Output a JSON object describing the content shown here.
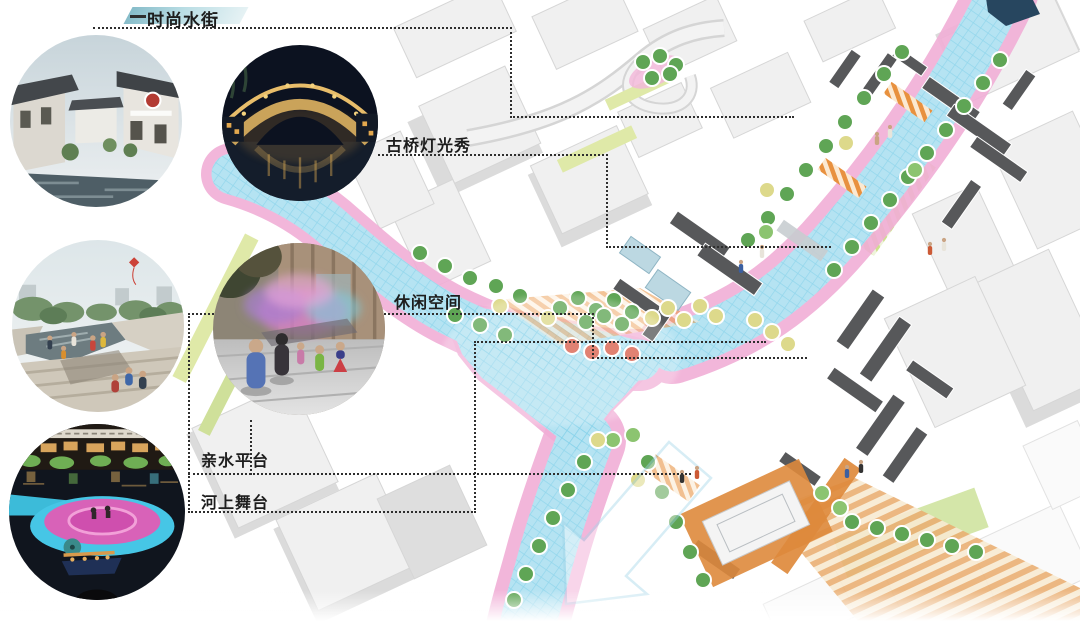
{
  "title": "waterfront-masterplan-diagram",
  "callouts": [
    {
      "id": "fashion-water-street",
      "label": "时尚水街",
      "photo": "traditional-water-street-rendering"
    },
    {
      "id": "bridge-light-show",
      "label": "古桥灯光秀",
      "photo": "stone-arch-bridge-night-photo"
    },
    {
      "id": "leisure-space",
      "label": "休闲空间",
      "photo": "mist-fountain-plaza-photo"
    },
    {
      "id": "waterfront-platform",
      "label": "亲水平台",
      "photo": "riverfront-terrace-steps-photo"
    },
    {
      "id": "river-stage",
      "label": "河上舞台",
      "photo": "floating-stage-night-photo"
    }
  ],
  "palette": {
    "water": "#b5e3f2",
    "water_grid": "#7fd0e8",
    "water_head": "#27465f",
    "bank_pink": "#f1aed6",
    "promenade_orange": "#e8913f",
    "grass": "#dfe9a8",
    "tree_green": "#5fa555",
    "tree_yellow": "#ddd98b",
    "tree_red": "#d95f4b",
    "roof_dark": "#57585a",
    "building_light": "#f0f0f0",
    "leader_line": "#2e2e2e",
    "label_text": "#1d1d1d",
    "highlight_teal": "#86bcc9"
  }
}
